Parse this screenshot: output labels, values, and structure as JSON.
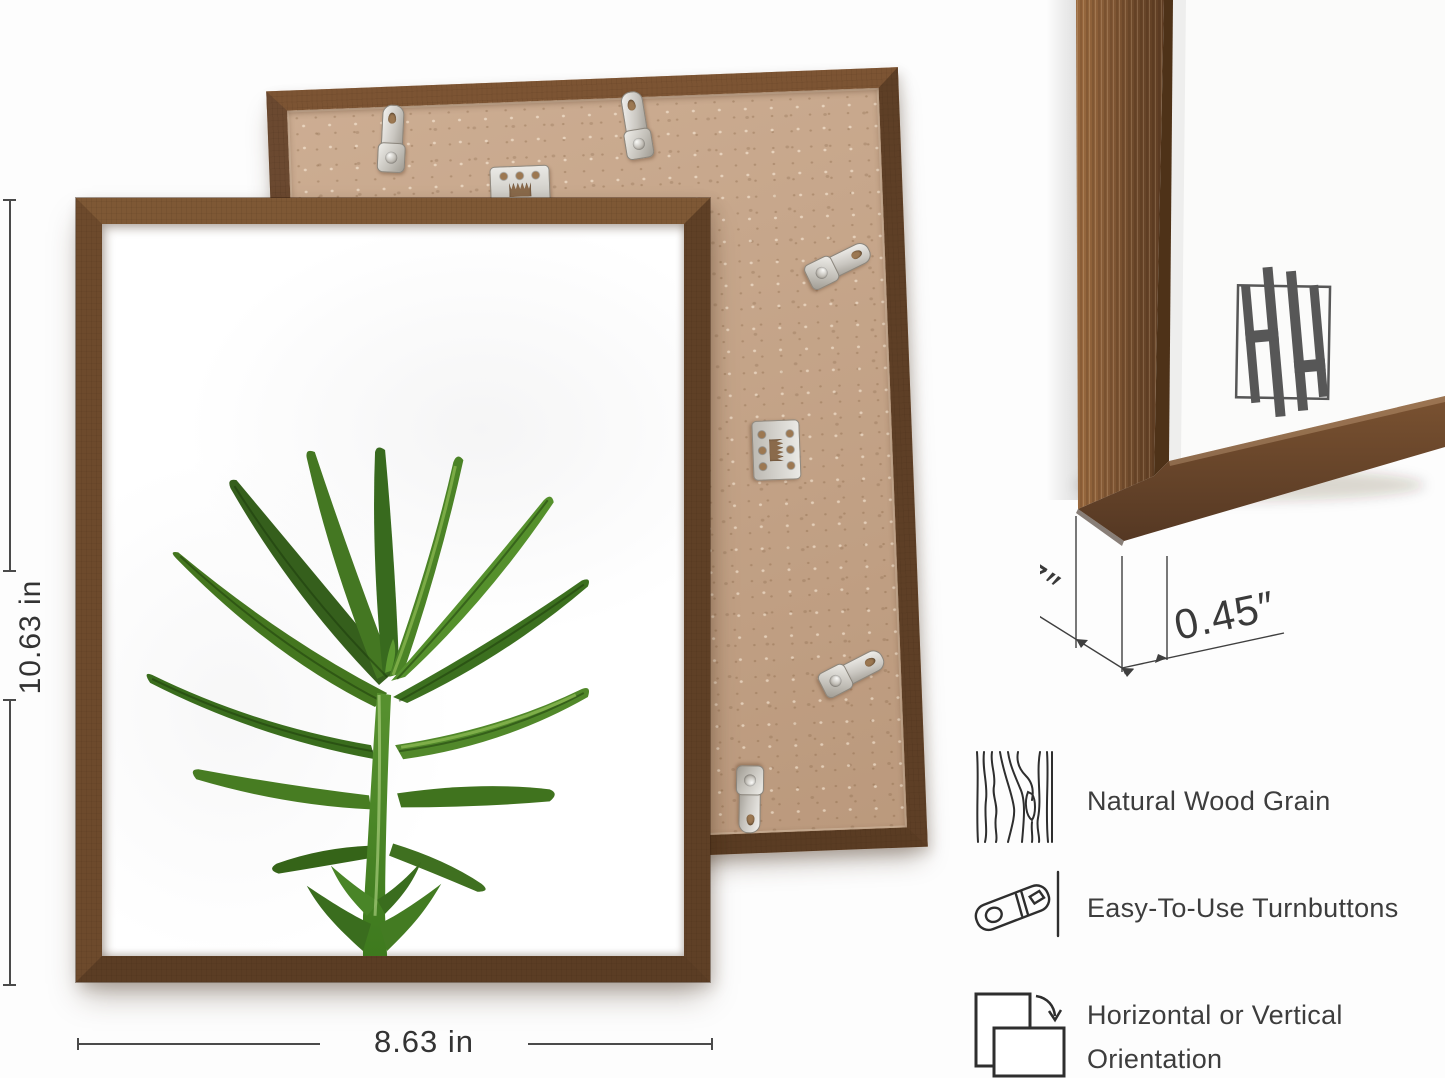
{
  "dimensions": {
    "frame_height": "10.63 in",
    "frame_width": "8.63 in",
    "frame_depth": "0.7″",
    "frame_face": "0.45″"
  },
  "features": [
    {
      "icon": "wood-grain-icon",
      "line1": "Natural Wood Grain",
      "line2": ""
    },
    {
      "icon": "turnbutton-icon",
      "line1": "Easy-To-Use Turnbuttons",
      "line2": ""
    },
    {
      "icon": "orientation-icon",
      "line1": "Horizontal or Vertical",
      "line2": "Orientation"
    }
  ],
  "brand_monogram": "HH",
  "colors": {
    "wood": "#6f4b2c",
    "wood_light": "#8a5f3a",
    "wood_dark": "#583a22",
    "mdf_board": "#c8a689",
    "metal_hardware": "#d9d6d0",
    "leaf_green": "#4c8527",
    "annotation_text": "#3a3a3a",
    "annotation_line": "#4a4a4a",
    "logo_gray": "#575757",
    "background": "#fdfdfd"
  }
}
